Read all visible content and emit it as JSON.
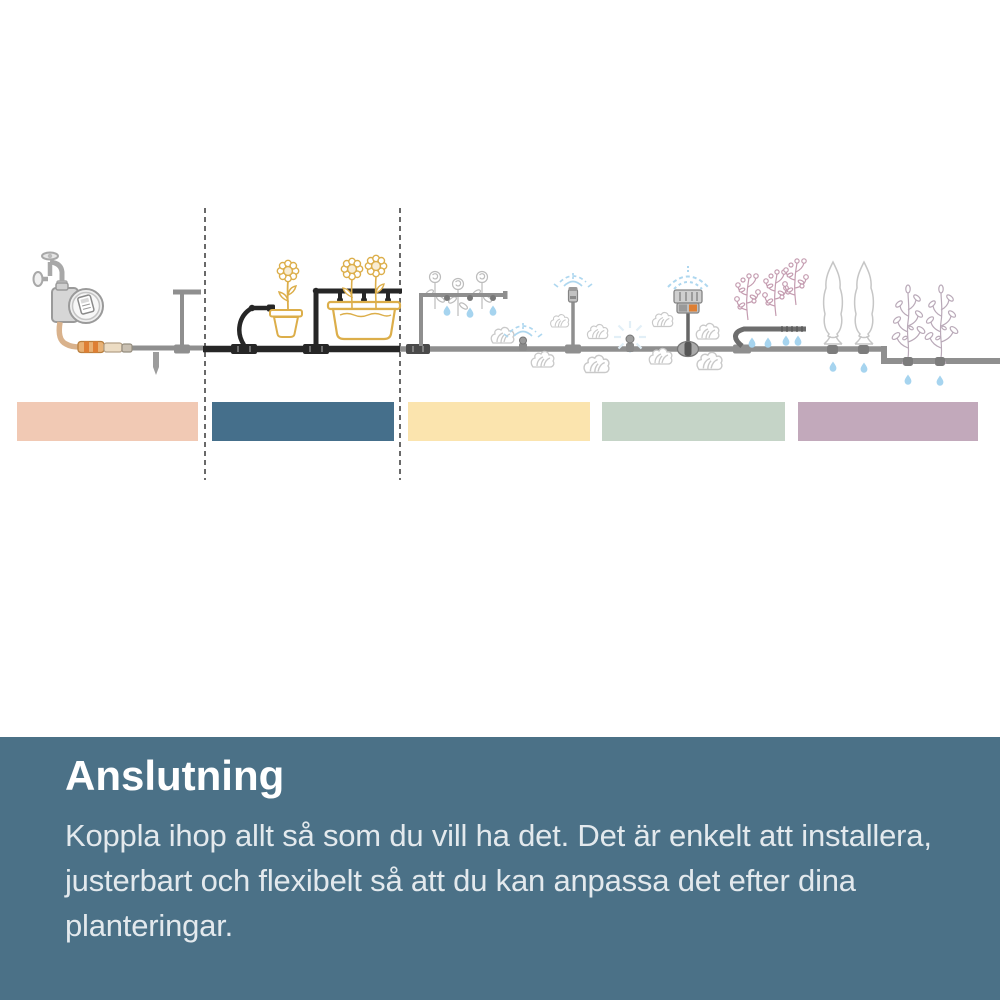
{
  "theme": {
    "page-bg": "#ffffff",
    "footer-bg": "#4b7187",
    "footer-heading": "#ffffff",
    "footer-text": "#e3e9ed",
    "pipe-gray": "#8f8f8f",
    "pipe-dark": "#262626",
    "water-blue": "#a6d4ef",
    "spray-blue": "#aed7ef",
    "sunflower-yellow": "#dcae4a",
    "sunflower-center": "#f8ecd2",
    "plant-gray": "#bcbcbc",
    "lettuce-gray": "#c9c9c9",
    "tomato-mauve": "#c49cb0",
    "shrub-mauve": "#b9a9b8",
    "hose-tan": "#d9b28c",
    "connector-orange": "#de7f34",
    "device-gray": "#9a9a9a"
  },
  "diagram": {
    "zone_bands": [
      {
        "position": 1,
        "color": "#f1c9b4",
        "highlighted": false
      },
      {
        "position": 2,
        "color": "#456f8b",
        "highlighted": true
      },
      {
        "position": 3,
        "color": "#fbe4ae",
        "highlighted": false
      },
      {
        "position": 4,
        "color": "#c5d4c7",
        "highlighted": false
      },
      {
        "position": 5,
        "color": "#c2a9bb",
        "highlighted": false
      }
    ],
    "components": [
      "garden-tap",
      "water-timer",
      "garden-hose",
      "hose-connector-orange",
      "ground-stake",
      "pipe-end-riser",
      "supply-pipe",
      "highlighted-connecting-pipe",
      "drip-emitters",
      "potted-sunflower",
      "planter-box-with-sunflowers",
      "rose-bed-drip-line",
      "lettuce-patch",
      "micro-sprinkler-on-pipe",
      "riser-micro-sprinkler",
      "large-sprinkler",
      "tomato-plants-drip-line",
      "cypress-trees",
      "shrub-row-drip-line"
    ]
  },
  "footer": {
    "heading": "Anslutning",
    "lines": [
      "Koppla ihop allt så som du vill ha det. Det är enkelt att installera,",
      "justerbart och flexibelt så att du kan anpassa det efter dina",
      "planteringar."
    ]
  }
}
